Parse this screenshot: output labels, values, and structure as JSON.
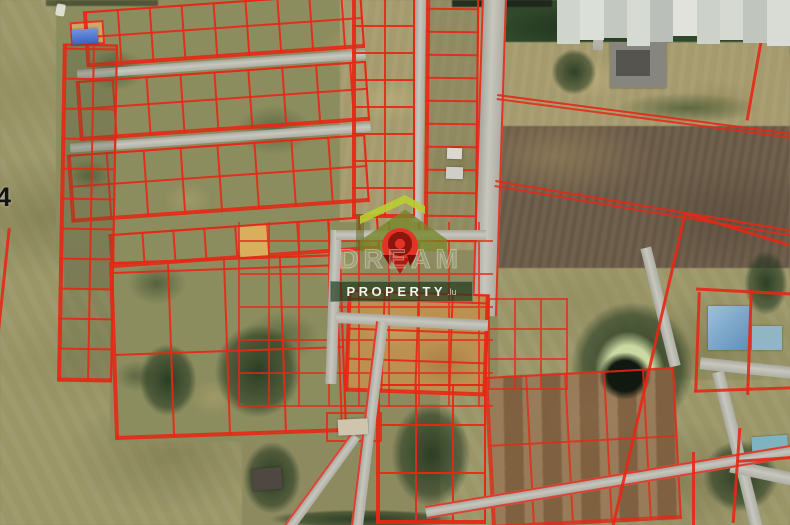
{
  "map": {
    "type": "satellite-cadastral",
    "road_label": "4",
    "parcel_line_color": "#e62816",
    "road_color": "#c0c0b7",
    "censor_blocks": [
      "#cfd4cd",
      "#dcdfd8",
      "#c3c8c1",
      "#d7dad3",
      "#bac0b9",
      "#e0e2db",
      "#ccd1ca",
      "#d6d9d2",
      "#c0c5be",
      "#d9dcd5"
    ],
    "features": {
      "highlighted_parcel_color": "#d9ae5c",
      "pond": "dark pond in forest clearing",
      "blue_roof_house": "#6f9cc4",
      "teal_roof_house": "#8fb6c2",
      "blue_tarp_building": "#3f6bc9"
    }
  },
  "watermark": {
    "outline_word": "DREAM",
    "bar_text": "PROPERTY",
    "bar_suffix": ".lu",
    "roof_light": "#b9cd32",
    "roof_dark": "#74862a",
    "pin_red": "#e23324",
    "pin_dark": "#8c150d",
    "bar_bg": "rgba(28,56,28,0.68)"
  }
}
